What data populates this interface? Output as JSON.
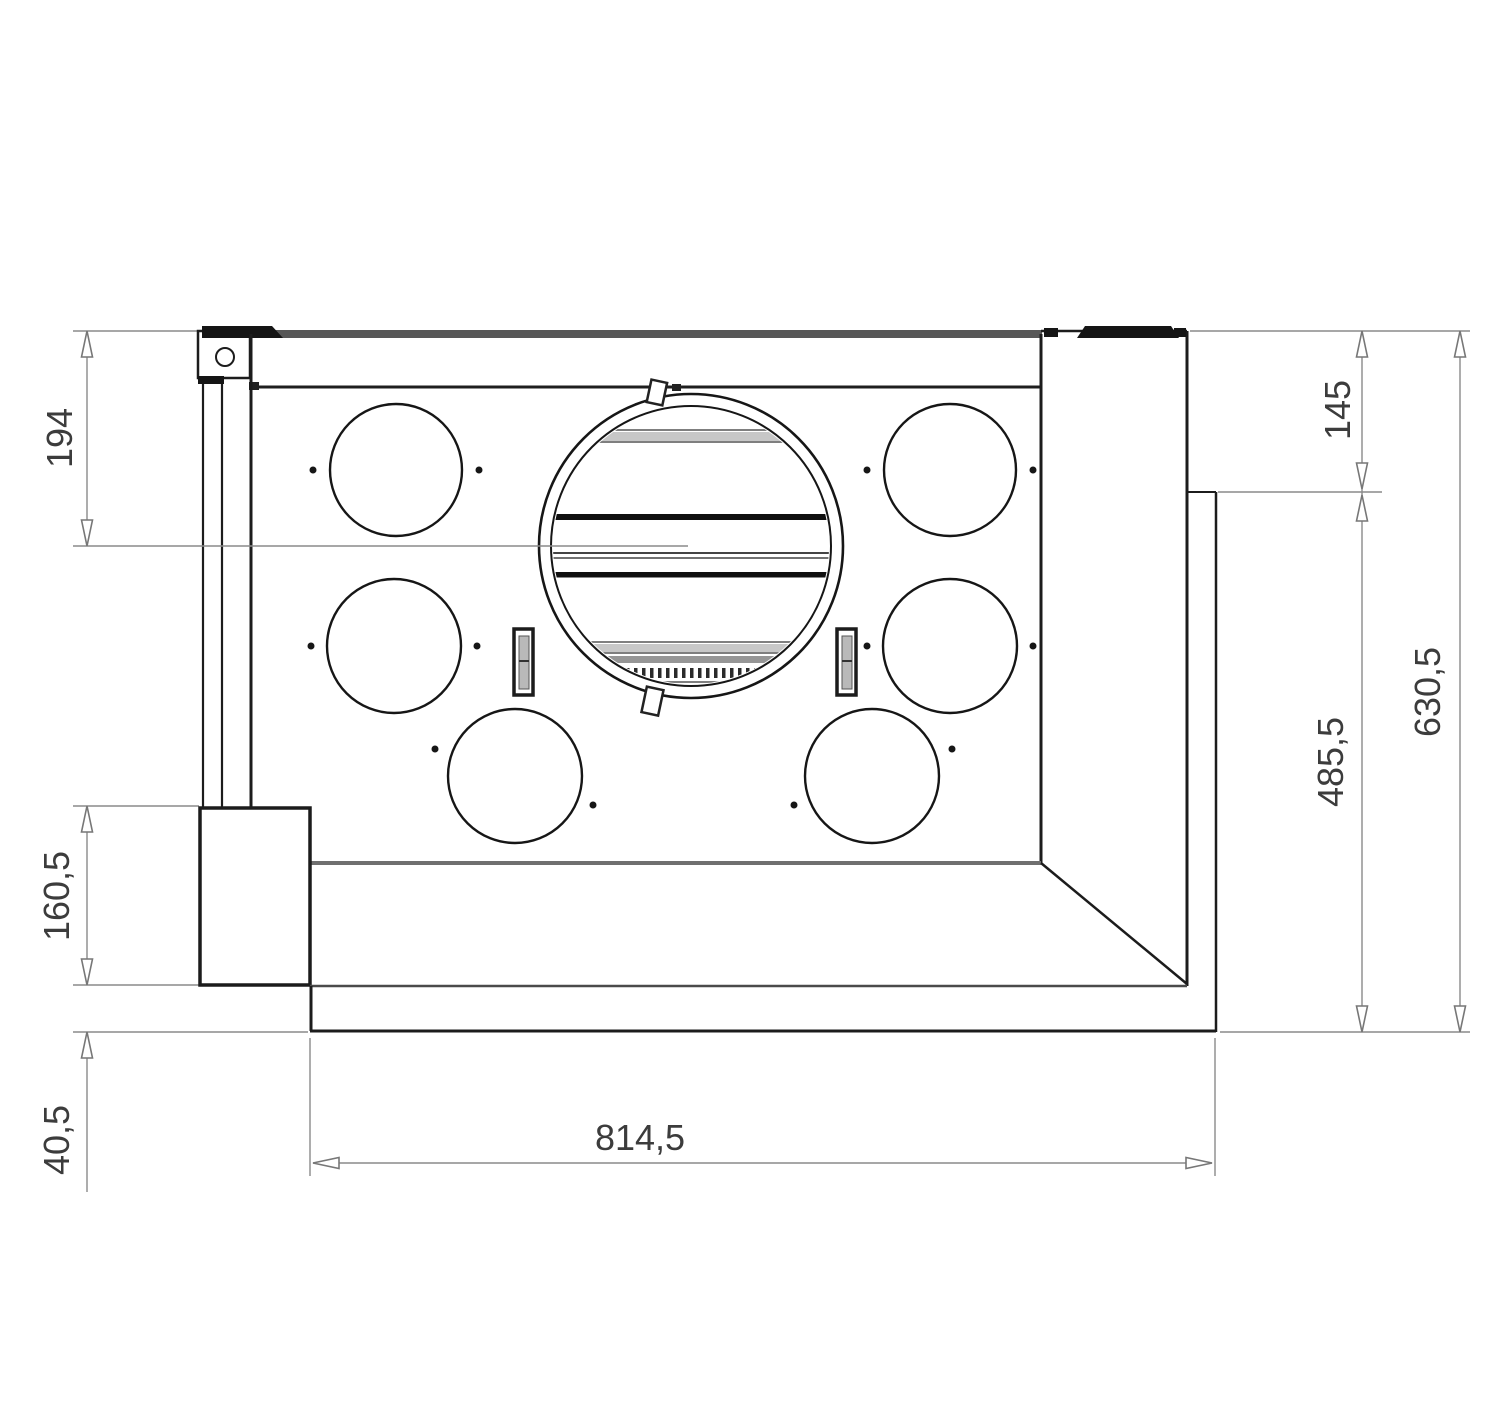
{
  "drawing": {
    "type": "technical-dimension-drawing",
    "subject": "built-in cooker hood, bottom view",
    "line_color": "#1c1c1c",
    "dim_color": "#8a8a8a",
    "text_color": "#3c3c3c",
    "dimensions": {
      "left": [
        {
          "id": "top-to-fan-center",
          "label": "194"
        },
        {
          "id": "side-box-height",
          "label": "160,5"
        },
        {
          "id": "bottom-flange-height",
          "label": "40,5"
        }
      ],
      "right": [
        {
          "id": "upper-depth",
          "label": "145"
        },
        {
          "id": "lower-depth",
          "label": "485,5"
        },
        {
          "id": "total-depth",
          "label": "630,5"
        }
      ],
      "bottom": [
        {
          "id": "overall-width",
          "label": "814,5"
        }
      ]
    }
  }
}
